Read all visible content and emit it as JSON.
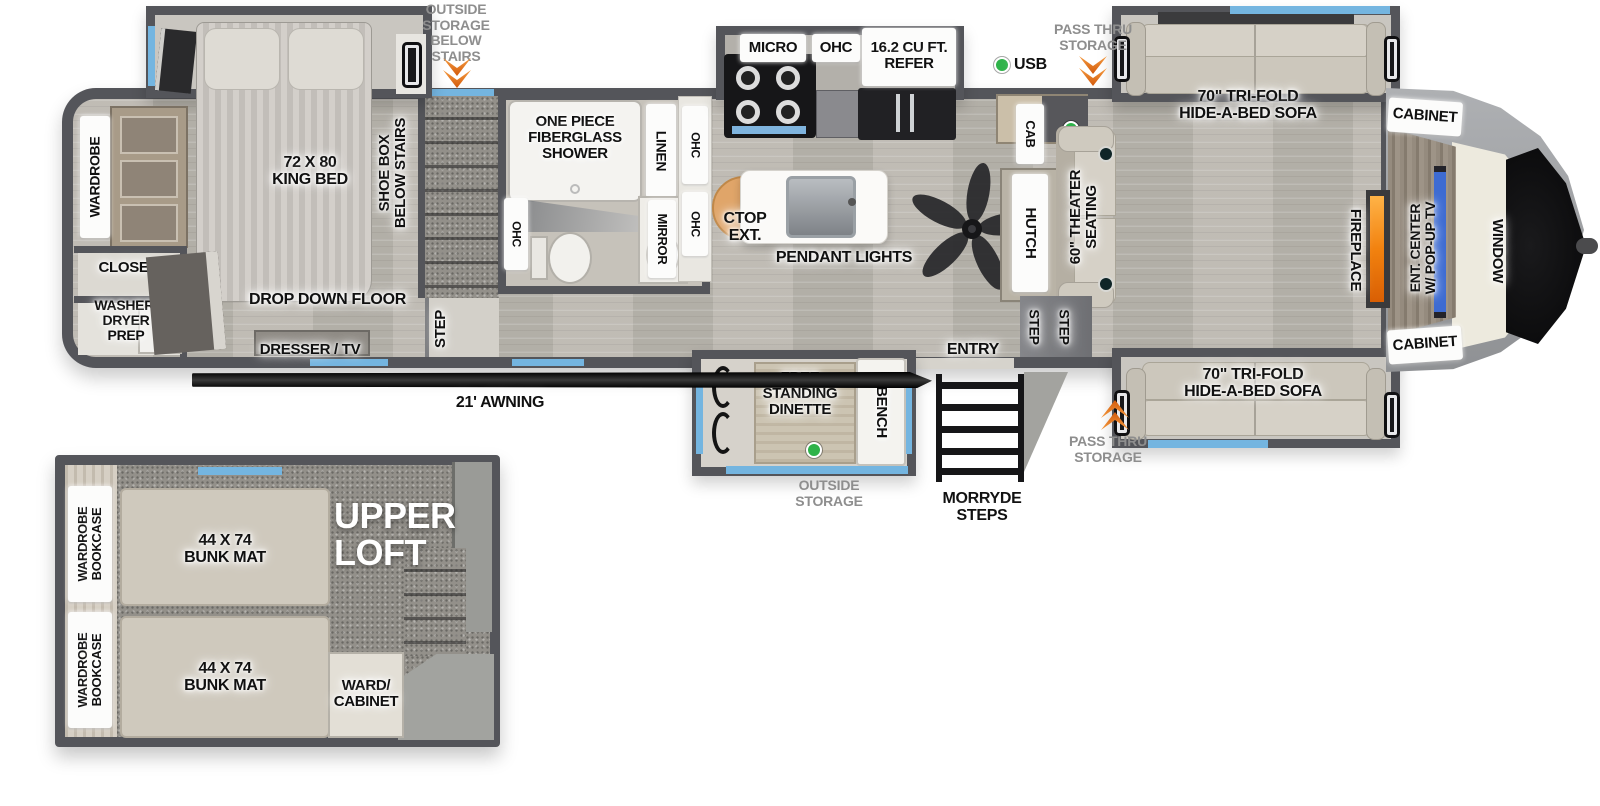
{
  "colors": {
    "wall": "#54555a",
    "window_blue": "#74b5e0",
    "chevron_orange": "#e8791e",
    "led_green": "#2fb34a",
    "fireplace_orange": "#f2820f",
    "tv_blue": "#3d6bd2"
  },
  "annotations": {
    "outside_storage_below_stairs": "OUTSIDE\nSTORAGE\nBELOW\nSTAIRS",
    "pass_thru_storage_top": "PASS THRU\nSTORAGE",
    "pass_thru_storage_bottom": "PASS THRU\nSTORAGE",
    "outside_storage_bottom": "OUTSIDE\nSTORAGE",
    "usb": "USB",
    "awning": "21' AWNING",
    "morryde_steps": "MORRYDE\nSTEPS",
    "entry": "ENTRY"
  },
  "bedroom": {
    "king_bed": "72 X 80\nKING BED",
    "shoe_box": "SHOE BOX\nBELOW STAIRS",
    "wardrobe": "WARDROBE",
    "closet": "CLOSET",
    "washer_dryer_prep": "WASHER/\nDRYER\nPREP",
    "drop_down_floor": "DROP DOWN FLOOR",
    "dresser_tv": "DRESSER / TV",
    "step": "STEP"
  },
  "bathroom": {
    "shower": "ONE PIECE\nFIBERGLASS\nSHOWER",
    "linen": "LINEN",
    "mirror": "MIRROR",
    "ohc_left": "OHC",
    "ohc_upper": "OHC",
    "ohc_lower": "OHC"
  },
  "kitchen": {
    "micro": "MICRO",
    "ohc": "OHC",
    "refer": "16.2 CU FT.\nREFER",
    "ctop_ext": "CTOP\nEXT.",
    "pendant_lights": "PENDANT LIGHTS",
    "cab": "CAB",
    "hutch": "HUTCH"
  },
  "living": {
    "sofa_top": "70\" TRI-FOLD\nHIDE-A-BED SOFA",
    "sofa_bottom": "70\" TRI-FOLD\nHIDE-A-BED SOFA",
    "cabinet_top": "CABINET",
    "cabinet_bottom": "CABINET",
    "window": "WINDOW",
    "ent_center": "ENT. CENTER\nW/ POP-UP TV",
    "fireplace": "FIREPLACE",
    "theater_seating": "60\" THEATER\nSEATING",
    "step_left": "STEP",
    "step_right": "STEP"
  },
  "dinette": {
    "free_standing": "FREE\nSTANDING\nDINETTE",
    "bench": "BENCH"
  },
  "loft": {
    "title": "UPPER\nLOFT",
    "bunk_upper": "44 X 74\nBUNK MAT",
    "bunk_lower": "44 X 74\nBUNK MAT",
    "wardrobe_bookcase_upper": "WARDROBE\nBOOKCASE",
    "wardrobe_bookcase_lower": "WARDROBE\nBOOKCASE",
    "ward_cabinet": "WARD/\nCABINET"
  }
}
